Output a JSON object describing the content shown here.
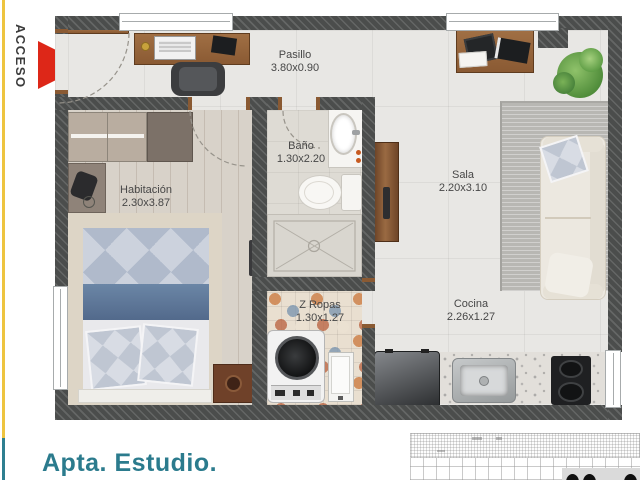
{
  "access": {
    "label": "ACCESO"
  },
  "title": "Apta. Estudio.",
  "rooms": [
    {
      "name": "Pasillo",
      "dims": "3.80x0.90"
    },
    {
      "name": "Habitación",
      "dims": "2.30x3.87"
    },
    {
      "name": "Baño",
      "dims": "1.30x2.20"
    },
    {
      "name": "Sala",
      "dims": "2.20x3.10"
    },
    {
      "name": "Z Ropas",
      "dims": "1.30x1.27"
    },
    {
      "name": "Cocina",
      "dims": "2.26x1.27"
    }
  ],
  "colors": {
    "accent_yellow": "#eec43f",
    "accent_teal": "#2e7f90",
    "arrow_red": "#dd2718",
    "title_teal": "#2b7b8d",
    "wall_gray": "#4b4d4c"
  },
  "icons": [
    "access-arrow-icon",
    "window-icon",
    "door-swing-icon",
    "entry-door",
    "bed",
    "wardrobe",
    "desk",
    "office-chair",
    "sofa",
    "pillow",
    "plant",
    "rug",
    "coffee-table",
    "pantry-door",
    "toilet",
    "bathroom-sink",
    "shower",
    "washing-machine",
    "utility-sink",
    "refrigerator",
    "kitchen-sink",
    "stove",
    "nightstand",
    "scale-grid"
  ]
}
